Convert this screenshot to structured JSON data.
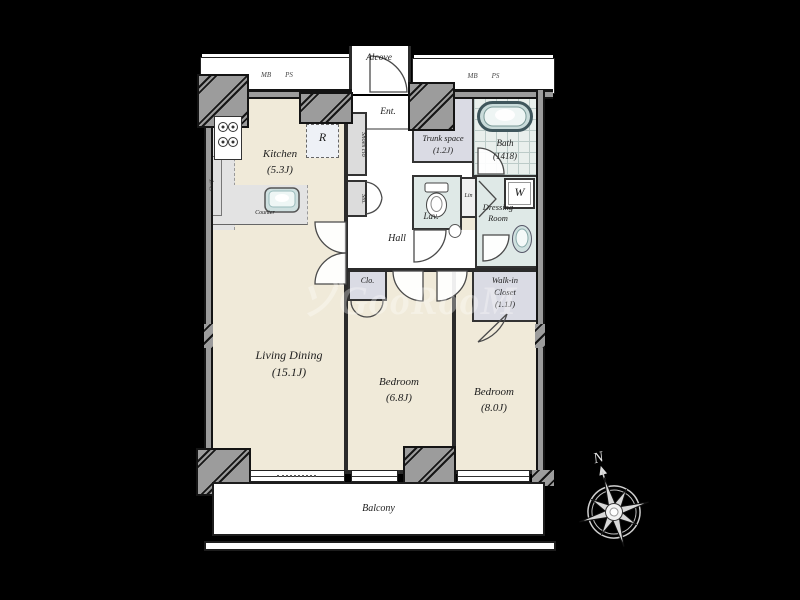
{
  "watermark_text": "ゾGooRooM",
  "compass": {
    "north_label": "N"
  },
  "meter_boxes": {
    "left": {
      "mb": "MB",
      "ps": "PS"
    },
    "right": {
      "mb": "MB",
      "ps": "PS"
    }
  },
  "rooms": {
    "alcove": {
      "name": "Alcove"
    },
    "entrance": {
      "name": "Ent."
    },
    "hall": {
      "name": "Hall"
    },
    "kitchen": {
      "name": "Kitchen",
      "size": "(5.3J)"
    },
    "living_dining": {
      "name": "Living Dining",
      "size": "(15.1J)"
    },
    "bedroom_small": {
      "name": "Bedroom",
      "size": "(6.8J)"
    },
    "bedroom_large": {
      "name": "Bedroom",
      "size": "(8.0J)"
    },
    "trunk_space": {
      "name": "Trunk space",
      "size": "(1.2J)"
    },
    "bath": {
      "name": "Bath",
      "size": "(1418)"
    },
    "lavatory": {
      "name": "Lav."
    },
    "dressing_room": {
      "name_line1": "Dressing",
      "name_line2": "Room"
    },
    "walk_in_closet": {
      "name_line1": "Walk-in",
      "name_line2": "Closet",
      "size": "(1.1J)"
    },
    "closet": {
      "name": "Clo."
    },
    "balcony": {
      "name": "Balcony"
    }
  },
  "fixtures": {
    "refrigerator_label": "R",
    "washer_label": "W",
    "linen_label": "Lin",
    "shoes_closet_label": "Shoes clo",
    "storage_label": "Sto.",
    "shelf_label": "Shelf",
    "counter_label": "Counter"
  },
  "colors": {
    "background": "#000000",
    "room_floor": "#f0ead9",
    "closet_floor": "#dadbe4",
    "wet_area_floor": "#dfe9e7",
    "wall": "#2b2b2b",
    "pillar": "#9c9c9c",
    "balcony": "#ffffff"
  }
}
